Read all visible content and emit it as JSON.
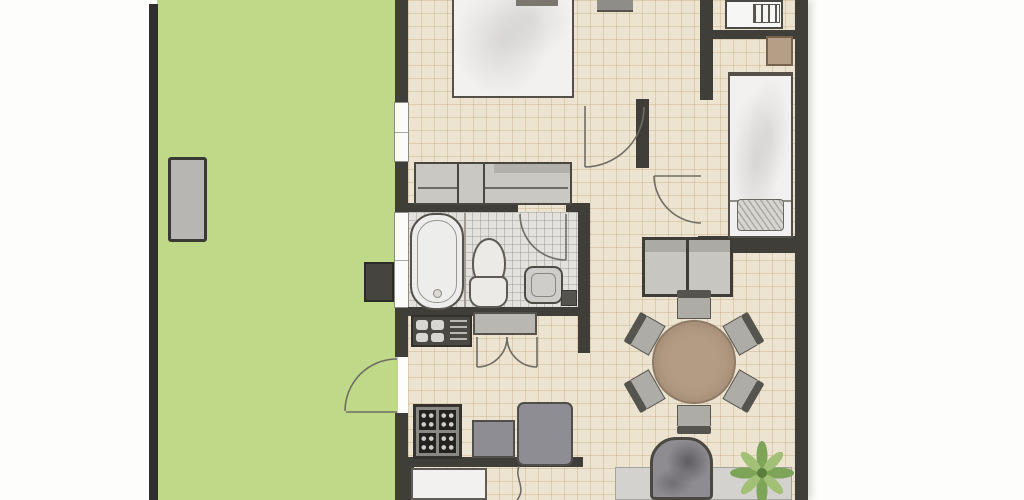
{
  "app": {
    "type": "floor-plan",
    "title": "Apartment floor plan with garden",
    "visible_text": []
  },
  "colors": {
    "wall": "#403e38",
    "wallDeep": "#312f2a",
    "garden": "#bfd989",
    "floor": "#ece3d1",
    "bathFloor": "#e2e1dd",
    "white": "#f2f1ef",
    "gray": "#c9c7c2",
    "appliance": "#8f8d94",
    "tableBrown": "#b49b83",
    "chair": "#aeaca7",
    "chairBack": "#56544e",
    "rug": "#d3d2ce",
    "brown": "#b59e86",
    "plantLeafDark": "#7da457",
    "plantLeafLight": "#a3c077",
    "doorArc": "#6f6c64"
  },
  "rooms": [
    {
      "id": "garden",
      "kind": "garden-terrace"
    },
    {
      "id": "bedroom-main",
      "kind": "bedroom"
    },
    {
      "id": "bedroom-second",
      "kind": "bedroom"
    },
    {
      "id": "bathroom",
      "kind": "bathroom"
    },
    {
      "id": "kitchen",
      "kind": "kitchen"
    },
    {
      "id": "living-dining",
      "kind": "living-dining"
    },
    {
      "id": "hallway",
      "kind": "hallway"
    }
  ],
  "furniture": [
    "garden-bench",
    "utility-box",
    "double-bed",
    "nightstand",
    "wardrobe",
    "bathtub",
    "toilet",
    "washbasin",
    "stove",
    "kitchen-counter",
    "appliance-grid-unit",
    "appliance-box",
    "fridge-box",
    "low-table",
    "dining-table-round",
    "dining-chair-x6",
    "sideboard-cabinet",
    "armchair",
    "rug",
    "potted-plant",
    "single-bed",
    "pillow",
    "desk-unit",
    "side-cabinet"
  ],
  "doors": [
    "garden-door",
    "main-bedroom-door",
    "second-bedroom-door",
    "bathroom-door",
    "kitchen-double-door"
  ],
  "windows": [
    "bedroom-window",
    "bathroom-window"
  ]
}
